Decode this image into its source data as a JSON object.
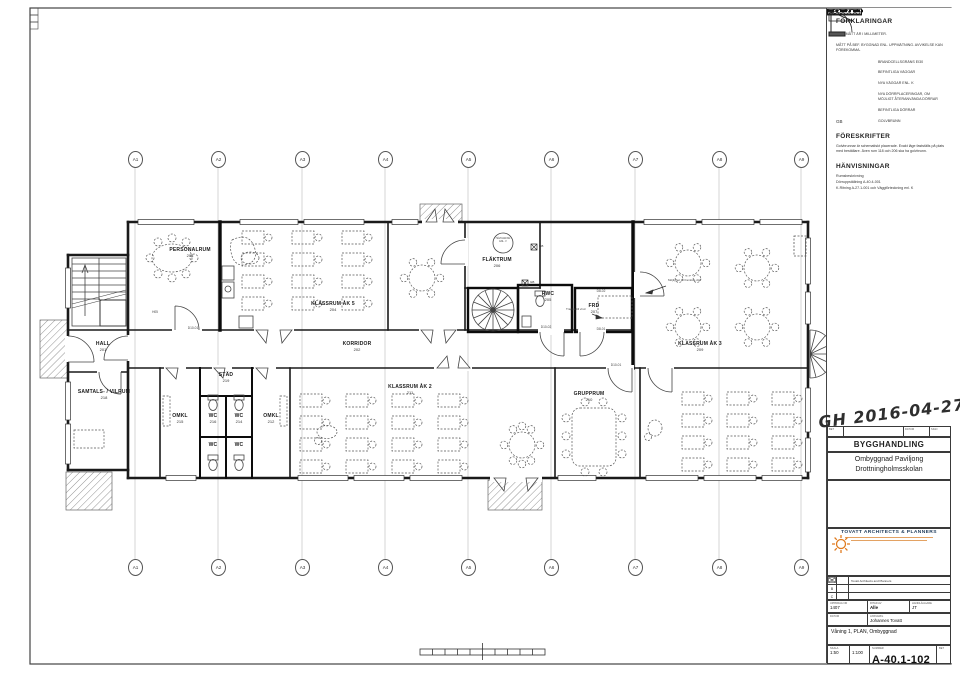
{
  "legend": {
    "title": "FÖRKLARINGAR",
    "notes": [
      "ALLA MÅTT ÄR I MILLIMETER.",
      "MÅTT PÅ BEF. BYGGNAD ENL. UPPMÄTNING. AVVIKELSE KAN FÖREKOMMA."
    ],
    "items": [
      {
        "symbol": "firewall-line",
        "label": "BRANDCELLSGRÄNS EI30"
      },
      {
        "symbol": "existing-wall",
        "label": "BEFINTLIGA VÄGGAR"
      },
      {
        "symbol": "new-wall",
        "label": "NYA VÄGGAR ENL. K"
      },
      {
        "symbol": "new-door",
        "label": "NYA DÖRRPLACERINGAR, OM MÖJLIGT ÅTERANVÄNDA DÖRRAR"
      },
      {
        "symbol": "existing-door",
        "label": "BEFINTLIGA DÖRRAR"
      },
      {
        "symbol": "gb-text",
        "symbol_text": "GB",
        "label": "GOLVBRUNN"
      }
    ],
    "prescriptions_title": "FÖRESKRIFTER",
    "prescriptions_text": "Golvbrunnar är schematiskt placerade. Exakt läge fastställs på plats med beställare. Även rum 118 och 206 ska ha golvbrunn.",
    "references_title": "HÄNVISNINGAR",
    "references": [
      "Rumsbeskrivning",
      "Dörruppställning A-40.4-001",
      "K-Ritning A-27.1-001 och Väggförteckning enl. K"
    ]
  },
  "stamp": {
    "handwritten": "GH 2016-04-27",
    "rev": {
      "bet": "BET",
      "datum": "DATUM",
      "sign": "SIGN"
    },
    "status": "BYGGHANDLING",
    "project_line1": "Ombyggnad Paviljong",
    "project_line2": "Drottningholmsskolan"
  },
  "firm": {
    "name": "TOVATT  ARCHITECTS & PLANNERS",
    "rows": [
      {
        "letter": "A",
        "name": "Tovatt Architects and Planners"
      },
      {
        "letter": "B",
        "name": ""
      },
      {
        "letter": "C",
        "name": ""
      }
    ]
  },
  "titleblock": {
    "field_uppdrag": {
      "label": "UPPDRAG NR",
      "value": "1407"
    },
    "field_ritad": {
      "label": "RITAD AV",
      "value": "Alle"
    },
    "field_handl": {
      "label": "HANDLÄGGARE",
      "value": "JT"
    },
    "field_datum": {
      "label": "DATUM",
      "value": ""
    },
    "field_ansvarig": {
      "label": "ANSVARIG",
      "value": "Johannes Tovatt"
    },
    "content": "Våning 1, PLAN, Ombyggnad",
    "scale": {
      "label": "SKALA",
      "a1": "1:50",
      "a3": "1:100"
    },
    "number": {
      "label": "NUMMER",
      "value": "A-40.1-102"
    },
    "bet_label": "BET"
  },
  "plan": {
    "grid_labels": [
      "A1",
      "A2",
      "A3",
      "A4",
      "A5",
      "A6",
      "A7",
      "A8",
      "A9"
    ],
    "rooms": [
      {
        "name": "PERSONALRUM",
        "number": "203"
      },
      {
        "name": "KLASSRUM ÅK 5",
        "number": "204"
      },
      {
        "name": "KORRIDOR",
        "number": "202"
      },
      {
        "name": "FLÄKTRUM",
        "number": "206"
      },
      {
        "name": "RWC",
        "number": "205"
      },
      {
        "name": "FRD",
        "number": "207"
      },
      {
        "name": "KLASSRUM ÅK 3",
        "number": "209"
      },
      {
        "name": "HALL",
        "number": "201"
      },
      {
        "name": "SAMTALS- / VILRUM",
        "number": "218"
      },
      {
        "name": "STÄD",
        "number": "219"
      },
      {
        "name": "WC",
        "number": "216"
      },
      {
        "name": "WC",
        "number": "214"
      },
      {
        "name": "WC",
        "number": ""
      },
      {
        "name": "WC",
        "number": ""
      },
      {
        "name": "OMKL",
        "number": "215"
      },
      {
        "name": "OMKL",
        "number": "212"
      },
      {
        "name": "KLASSRUM ÅK 2",
        "number": "211"
      },
      {
        "name": "GRUPPRUM",
        "number": "210"
      }
    ],
    "door_labels": [
      "D10-01",
      "D10-02",
      "D8-01",
      "D8-02",
      "D10-01",
      "H05"
    ],
    "annotations": {
      "vent": "HÅLTAGNING ENL. V",
      "attic": "Trappa till vind",
      "future_door": "Möjlighet till framtida dörr",
      "gb": "GB"
    }
  }
}
